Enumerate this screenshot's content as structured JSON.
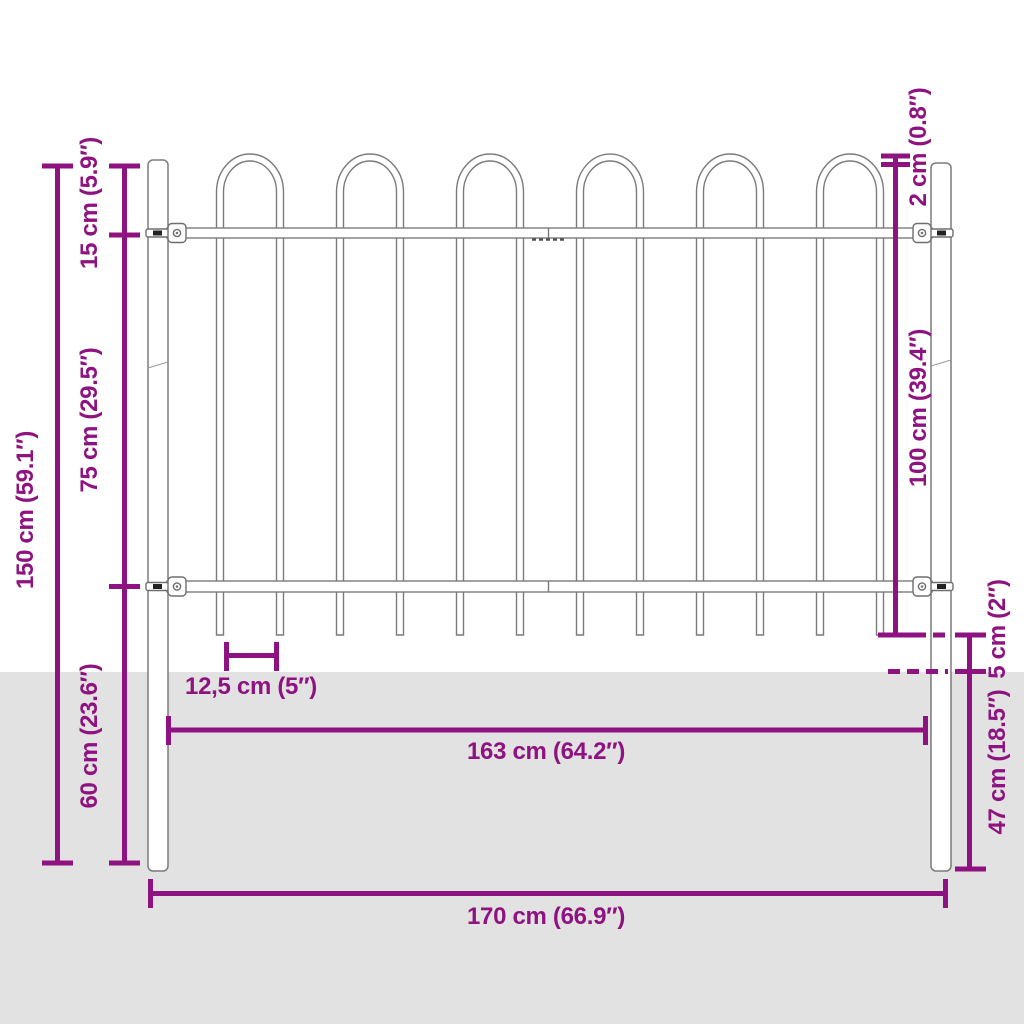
{
  "figure": {
    "hoop_count": 6,
    "picket_count": 12,
    "post_count": 2,
    "rail_count": 2
  },
  "colors": {
    "dimension_accent": "#8E1380",
    "ground": "#E3E2E2",
    "fence_outline": "#7B7B7B",
    "background": "#FFFFFF"
  },
  "dimensions": {
    "total_height": "150 cm (59.1″)",
    "hoop_height": "15 cm (5.9″)",
    "rail_spacing": "75 cm (29.5″)",
    "below_rail_height": "60 cm (23.6″)",
    "hoop_above_post": "2 cm (0.8″)",
    "panel_height": "100 cm (39.4″)",
    "spike_ground_gap": "5 cm (2″)",
    "post_depth": "47 cm (18.5″)",
    "bar_spacing": "12,5 cm (5″)",
    "panel_width": "163 cm (64.2″)",
    "total_width": "170 cm (66.9″)"
  }
}
